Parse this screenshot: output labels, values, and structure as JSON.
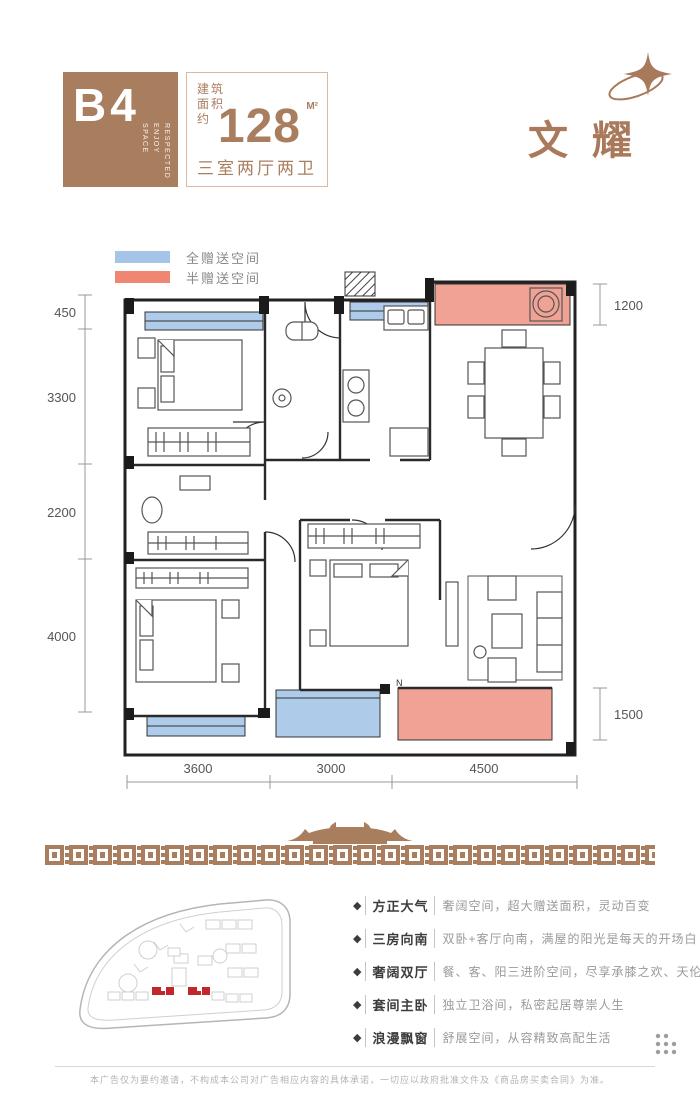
{
  "header": {
    "unit_label": "B4",
    "tagline_words": [
      "RESPECTED",
      "ENJOY",
      "SPACE"
    ],
    "area_prefix_lines": "建筑\n面积\n约",
    "area_value": "128",
    "area_unit": "M²",
    "layout_label": "三室两厅两卫",
    "brand_name": "文耀",
    "brand_color": "#a8795a",
    "block_color": "#a97e5f"
  },
  "legend": {
    "items": [
      {
        "label": "全赠送空间",
        "color": "#a5c5e8"
      },
      {
        "label": "半赠送空间",
        "color": "#ee8672"
      }
    ]
  },
  "floorplan": {
    "dim_left": [
      "450",
      "3300",
      "2200",
      "4000"
    ],
    "dim_right": [
      "1200",
      "1500"
    ],
    "dim_bottom": [
      "3600",
      "3000",
      "4500"
    ],
    "north_label": "N",
    "full_gift_color": "#aecbea",
    "half_gift_color": "#f0a294"
  },
  "features": [
    {
      "title": "方正大气",
      "desc": "奢阔空间，超大赠送面积，灵动百变"
    },
    {
      "title": "三房向南",
      "desc": "双卧+客厅向南，满屋的阳光是每天的开场白"
    },
    {
      "title": "奢阔双厅",
      "desc": "餐、客、阳三进阶空间，尽享承膝之欢、天伦之乐"
    },
    {
      "title": "套间主卧",
      "desc": "独立卫浴间，私密起居尊崇人生"
    },
    {
      "title": "浪漫飘窗",
      "desc": "舒展空间，从容精致高配生活"
    }
  ],
  "site_plan": {
    "highlight_color": "#c1272d"
  },
  "icons": [
    "sparkle-orbit-icon",
    "diamond-bullet-icon",
    "roof-ornament-icon",
    "dots-grid-icon"
  ],
  "footer": {
    "disclaimer": "本广告仅为要约邀请，不构成本公司对广告相应内容的具体承诺，一切应以政府批准文件及《商品房买卖合同》为准。"
  }
}
